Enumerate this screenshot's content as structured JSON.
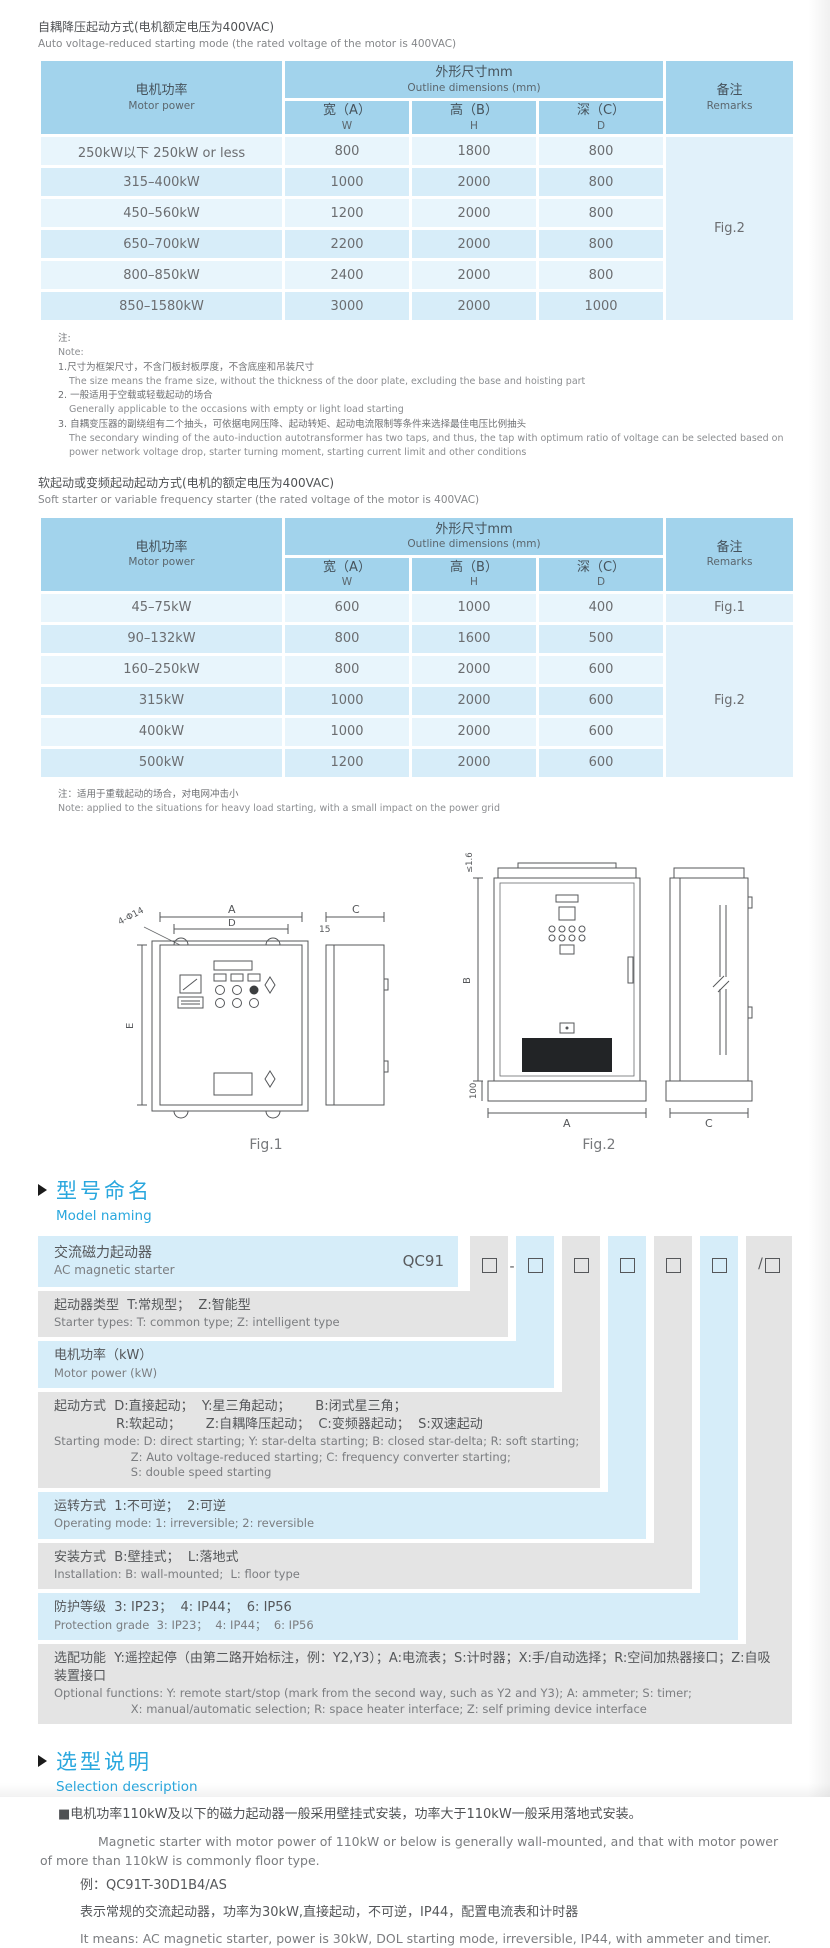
{
  "accent_color": "#29a7de",
  "table1": {
    "title_zh": "自耦降压起动方式(电机额定电压为400VAC)",
    "title_en": "Auto voltage-reduced starting mode (the rated voltage of the motor is 400VAC)",
    "header": {
      "motor_power_zh": "电机功率",
      "motor_power_en": "Motor power",
      "outline_zh": "外形尺寸mm",
      "outline_en": "Outline dimensions (mm)",
      "width_zh": "宽（A）",
      "width_en": "W",
      "height_zh": "高（B）",
      "height_en": "H",
      "depth_zh": "深（C）",
      "depth_en": "D",
      "remarks_zh": "备注",
      "remarks_en": "Remarks"
    },
    "rows": [
      {
        "power": "250kW以下 250kW or less",
        "w": "800",
        "h": "1800",
        "d": "800"
      },
      {
        "power": "315–400kW",
        "w": "1000",
        "h": "2000",
        "d": "800"
      },
      {
        "power": "450–560kW",
        "w": "1200",
        "h": "2000",
        "d": "800"
      },
      {
        "power": "650–700kW",
        "w": "2200",
        "h": "2000",
        "d": "800"
      },
      {
        "power": "800–850kW",
        "w": "2400",
        "h": "2000",
        "d": "800"
      },
      {
        "power": "850–1580kW",
        "w": "3000",
        "h": "2000",
        "d": "1000"
      }
    ],
    "remark": "Fig.2"
  },
  "notes1": {
    "zh_label": "注:",
    "en_label": "Note:",
    "items": [
      {
        "zh": "1.尺寸为框架尺寸，不含门板封板厚度，不含底座和吊装尺寸",
        "en": "The size means the frame size, without the thickness of the door plate, excluding the base and hoisting part"
      },
      {
        "zh": "2. 一般适用于空载或轻载起动的场合",
        "en": "Generally applicable to the occasions with empty or light load starting"
      },
      {
        "zh": "3. 自耦变压器的副绕组有二个抽头，可依据电网压降、起动转矩、起动电流限制等条件来选择最佳电压比例抽头",
        "en": "The secondary winding of the auto-induction autotransformer has two taps, and thus, the tap with optimum ratio of voltage can be selected based on power network voltage drop, starter turning moment, starting current limit and other conditions"
      }
    ]
  },
  "table2": {
    "title_zh": "软起动或变频起动起动方式(电机的额定电压为400VAC)",
    "title_en": "Soft starter or variable frequency starter (the rated voltage of the motor is 400VAC)",
    "rows": [
      {
        "power": "45–75kW",
        "w": "600",
        "h": "1000",
        "d": "400"
      },
      {
        "power": "90–132kW",
        "w": "800",
        "h": "1600",
        "d": "500"
      },
      {
        "power": "160–250kW",
        "w": "800",
        "h": "2000",
        "d": "600"
      },
      {
        "power": "315kW",
        "w": "1000",
        "h": "2000",
        "d": "600"
      },
      {
        "power": "400kW",
        "w": "1000",
        "h": "2000",
        "d": "600"
      },
      {
        "power": "500kW",
        "w": "1200",
        "h": "2000",
        "d": "600"
      }
    ],
    "remark_row1": "Fig.1",
    "remark_rest": "Fig.2"
  },
  "note2": {
    "zh": "注：适用于重载起动的场合，对电网冲击小",
    "en": "Note: applied to the situations for heavy load starting, with a small impact on the power grid"
  },
  "figures": {
    "fig1_caption": "Fig.1",
    "fig2_caption": "Fig.2",
    "fig1_labels": {
      "a": "A",
      "d": "D",
      "e": "E",
      "c": "C",
      "hole": "4-Φ14",
      "offset": "15"
    },
    "fig2_labels": {
      "a": "A",
      "b": "B",
      "c": "C",
      "top": "≤1.6",
      "bottom": "100"
    }
  },
  "model_naming": {
    "heading_zh": "型号命名",
    "heading_en": "Model naming",
    "product_zh": "交流磁力起动器",
    "product_en": "AC magnetic starter",
    "code": "QC91",
    "minus": "-",
    "slash": "/",
    "rows": [
      {
        "zh": "起动器类型  T:常规型；  Z:智能型",
        "en": "Starter types: T: common type; Z: intelligent type"
      },
      {
        "zh": "电机功率（kW）",
        "en": "Motor power (kW)"
      },
      {
        "zh": "起动方式  D:直接起动；  Y:星三角起动；      B:闭式星三角；\n               R:软起动；      Z:自耦降压起动；  C:变频器起动；  S:双速起动",
        "en": "Starting mode: D: direct starting; Y: star-delta starting; B: closed star-delta; R: soft starting;\n                     Z: Auto voltage-reduced starting; C: frequency converter starting;\n                     S: double speed starting"
      },
      {
        "zh": "运转方式  1:不可逆；  2:可逆",
        "en": "Operating mode: 1: irreversible; 2: reversible"
      },
      {
        "zh": "安装方式  B:壁挂式；  L:落地式",
        "en": "Installation: B: wall-mounted;  L: floor type"
      },
      {
        "zh": "防护等级  3: IP23；  4: IP44；  6: IP56",
        "en": "Protection grade  3: IP23；  4: IP44；  6: IP56"
      },
      {
        "zh": "选配功能  Y:遥控起停（由第二路开始标注，例：Y2,Y3）；A:电流表；S:计时器；X:手/自动选择；R:空间加热器接口；Z:自吸装置接口",
        "en": "Optional functions: Y: remote start/stop (mark from the second way, such as Y2 and Y3); A: ammeter; S: timer;\n                     X: manual/automatic selection; R: space heater interface; Z: self priming device interface"
      }
    ]
  },
  "selection": {
    "heading_zh": "选型说明",
    "heading_en": "Selection description",
    "p1_zh": "■电机功率110kW及以下的磁力起动器一般采用壁挂式安装，功率大于110kW一般采用落地式安装。",
    "p1_en": "Magnetic starter with motor power of 110kW or below is generally wall-mounted, and that with motor power of more than 110kW is commonly floor type.",
    "example": "例：QC91T-30D1B4/AS",
    "p2_zh": "表示常规的交流起动器，功率为30kW,直接起动，不可逆，IP44，配置电流表和计时器",
    "p2_en": "It means: AC magnetic starter, power is 30kW, DOL starting mode, irreversible, IP44, with ammeter and timer."
  }
}
